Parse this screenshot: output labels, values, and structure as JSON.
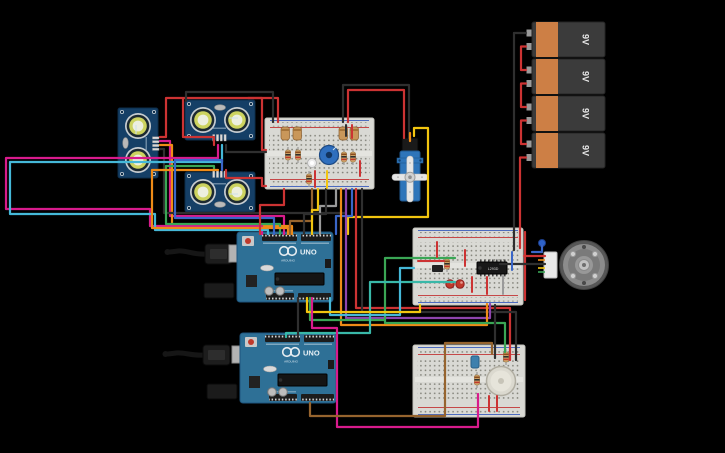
{
  "canvas": {
    "background": "#000000",
    "width": 725,
    "height": 453
  },
  "batteries": {
    "items": [
      {
        "label": "9V"
      },
      {
        "label": "9V"
      },
      {
        "label": "9V"
      },
      {
        "label": "9V"
      }
    ]
  },
  "arduino1": {
    "brand": "ARDUINO",
    "model": "UNO"
  },
  "arduino2": {
    "brand": "ARDUINO",
    "model": "UNO"
  },
  "chip": {
    "label": "L293D"
  },
  "components": [
    {
      "name": "ultrasonic-distance-sensor",
      "count": 3
    },
    {
      "name": "small-breadboard",
      "count": 3
    },
    {
      "name": "arduino-uno",
      "count": 2
    },
    {
      "name": "9v-battery",
      "count": 4
    },
    {
      "name": "micro-servo",
      "count": 1
    },
    {
      "name": "dc-motor",
      "count": 1
    },
    {
      "name": "piezo-buzzer",
      "count": 1
    },
    {
      "name": "motor-driver-ic",
      "count": 1
    },
    {
      "name": "potentiometer",
      "count": 1
    },
    {
      "name": "usb-cable",
      "count": 2
    }
  ],
  "colors": {
    "board_blue": "#2e7096",
    "breadboard": "#d9d9d4",
    "battery_body": "#3b3b3b",
    "battery_band": "#cd7f45",
    "wire_red": "#cc3333",
    "wire_black": "#2f2f2f",
    "wire_yellow": "#f2c50f",
    "wire_orange": "#ef8b17",
    "wire_green": "#3aa655",
    "wire_teal": "#39b8a8",
    "wire_cyan": "#45b8d8",
    "wire_blue": "#3a66c8",
    "wire_purple": "#8e44ad",
    "wire_magenta": "#d81b8c",
    "wire_brown": "#96642e",
    "wire_gray": "#9a9a9a"
  }
}
